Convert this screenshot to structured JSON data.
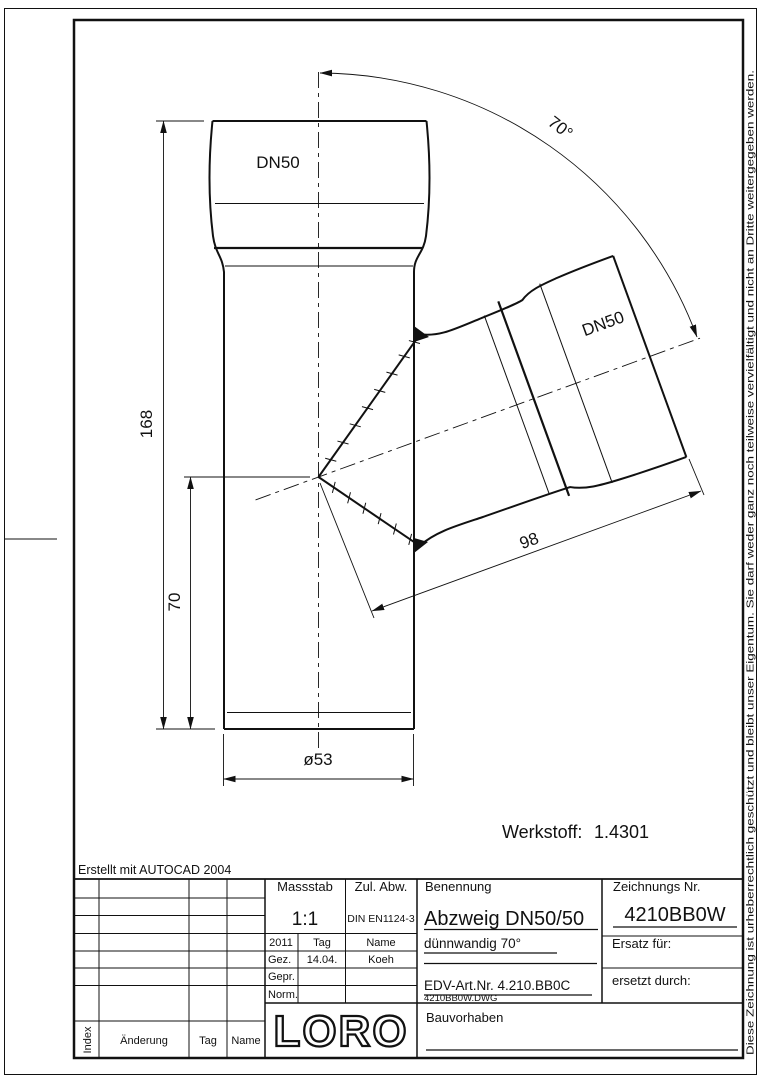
{
  "page": {
    "erstellt_note": "Erstellt mit AUTOCAD 2004",
    "copyright_vertical": "Diese Zeichnung ist urheberrechtlich geschützt und bleibt unser Eigentum. Sie darf weder ganz noch teilweise vervielfältigt und nicht an Dritte weitergegeben werden.",
    "werkstoff_label": "Werkstoff:",
    "werkstoff_value": "1.4301"
  },
  "drawing": {
    "dn50_top": "DN50",
    "dn50_branch": "DN50",
    "dim_height_total": "168",
    "dim_height_branch": "70",
    "dim_diameter": "ø53",
    "dim_branch_length": "98",
    "dim_angle": "70°"
  },
  "titleblock": {
    "massstab_label": "Massstab",
    "massstab_value": "1:1",
    "zul_abw_label": "Zul. Abw.",
    "zul_abw_value": "DIN EN1124-3",
    "benennung_label": "Benennung",
    "benennung_value": "Abzweig DN50/50",
    "benennung_line2": "dünnwandig 70°",
    "edv_art": "EDV-Art.Nr.  4.210.BB0C",
    "dwg_file": "4210BB0W.DWG",
    "zeichnung_nr_label": "Zeichnungs Nr.",
    "zeichnung_nr_value": "4210BB0W",
    "ersatz_label": "Ersatz für:",
    "ersetzt_label": "ersetzt durch:",
    "bauvorhaben_label": "Bauvorhaben",
    "logo": "LORO",
    "approval": {
      "year": "2011",
      "tag_header": "Tag",
      "name_header": "Name",
      "gez_label": "Gez.",
      "gez_date": "14.04.",
      "gez_name": "Koeh",
      "gepr_label": "Gepr.",
      "norm_label": "Norm."
    },
    "revision": {
      "index_label": "Index",
      "aenderung_label": "Änderung",
      "tag_label": "Tag",
      "name_label": "Name"
    }
  }
}
